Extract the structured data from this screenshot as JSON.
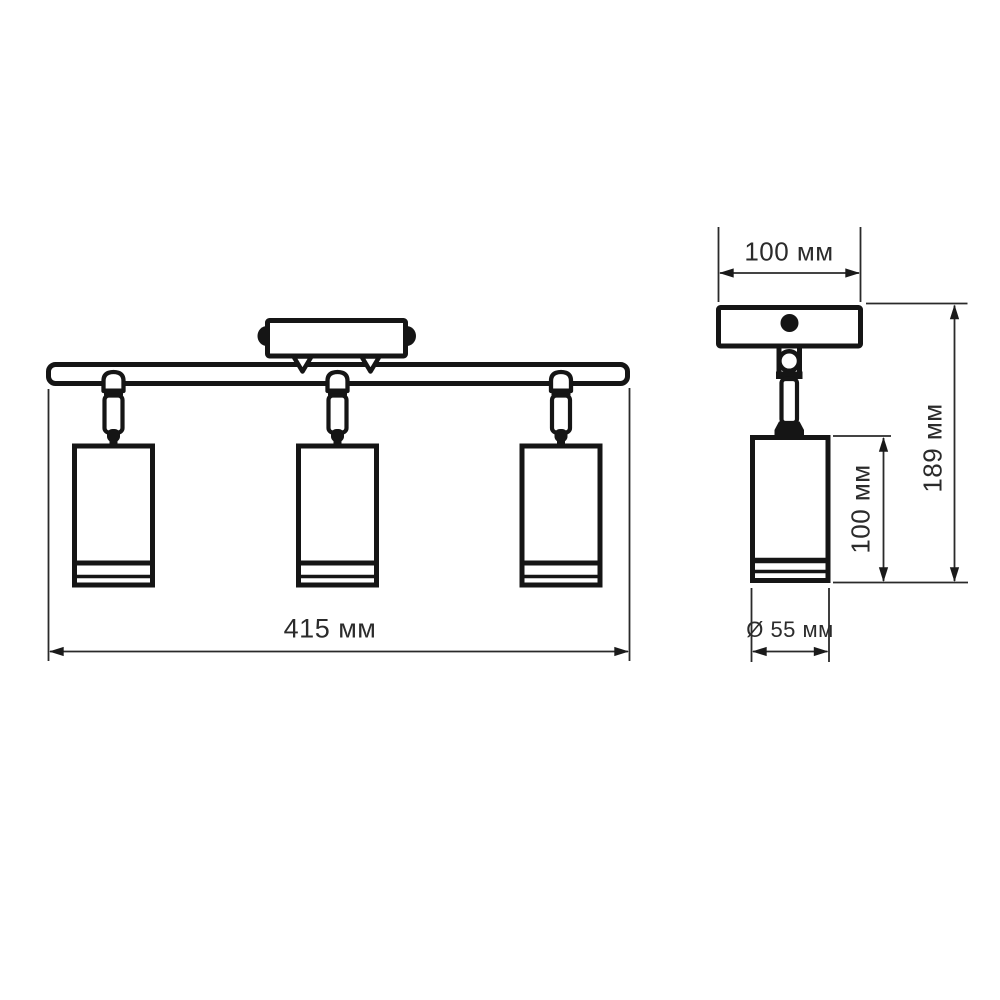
{
  "diagram": {
    "type": "technical drawing — ceiling spotlight fixture, two orthographic views",
    "front_view": {
      "overall_width_label": "415 мм",
      "spot_count": 3
    },
    "side_view": {
      "canopy_width_label": "100 мм",
      "body_height_label": "100 мм",
      "overall_height_label": "189 мм",
      "body_diameter_label": "Ø 55 мм"
    },
    "colors": {
      "line": "#151515",
      "dimension_line": "#2a2a2a",
      "text": "#2b2b2b",
      "background": "#ffffff"
    }
  }
}
